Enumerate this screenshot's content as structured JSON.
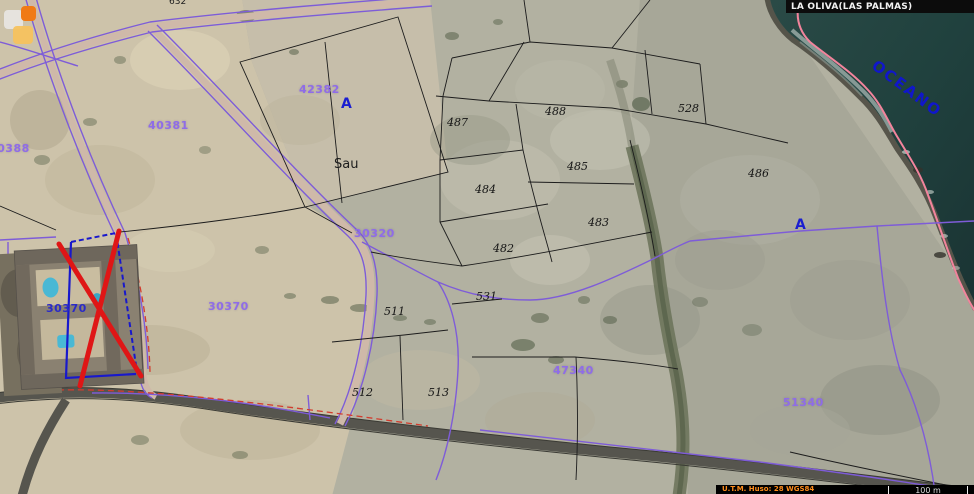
{
  "header": {
    "municipality": "LA OLIVA(LAS PALMAS)"
  },
  "footer": {
    "projection": "U.T.M. Huso: 28 WGS84",
    "scale_label": "100 m"
  },
  "ocean": {
    "label": "OCEANO"
  },
  "places": {
    "sau": "Sau"
  },
  "zones": {
    "a_top": "A",
    "a_right": "A"
  },
  "polygon_labels": {
    "p40381": "40381",
    "p42382": "42382",
    "p30388": "30388",
    "p30320": "30320",
    "p30370": "30370",
    "p30370_blue": "30370",
    "p47340": "47340",
    "p51340": "51340"
  },
  "parcel_labels": {
    "n632": "632",
    "n487": "487",
    "n488": "488",
    "n528": "528",
    "n485": "485",
    "n484": "484",
    "n486": "486",
    "n483": "483",
    "n482": "482",
    "n511": "511",
    "n531": "531",
    "n512": "512",
    "n513": "513"
  },
  "colors": {
    "cadastral_purple": "#8f6ce8",
    "parcel_line_black": "#1c1c1c",
    "coastline_pink": "#f2849c",
    "annotation_red": "#df1616",
    "annotation_blue": "#1818cc",
    "ocean_dark_teal": "#20413e",
    "sand": "#cdc3aa",
    "scrub_gray": "#a7a798"
  }
}
